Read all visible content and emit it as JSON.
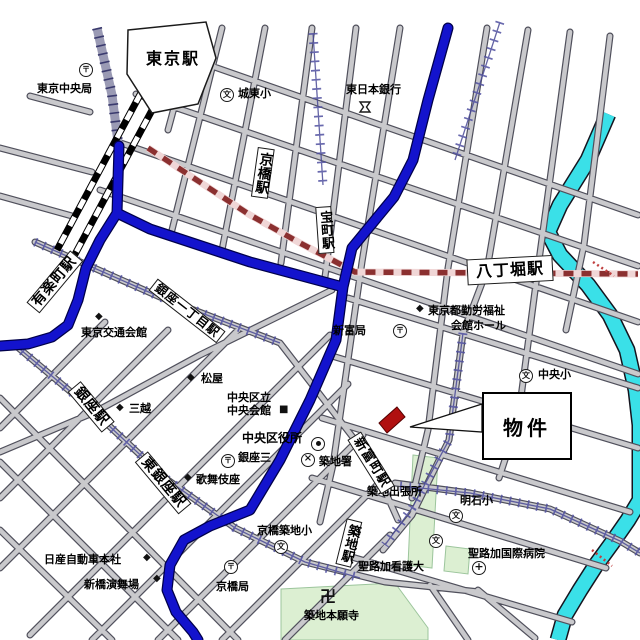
{
  "map": {
    "stations": {
      "tokyo": "東京駅",
      "yurakucho": "有楽町駅",
      "kyobashi": "京橋駅",
      "takaracho": "宝町駅",
      "hatchobori": "八丁堀駅",
      "ginza_itchome": "銀座一丁目駅",
      "ginza": "銀座駅",
      "higashi_ginza": "東銀座駅",
      "shintomicho": "新富町駅",
      "tsukiji": "築地駅"
    },
    "landmarks": {
      "tokyo_chuo_post": "東京中央局",
      "joto_elem": "城東小",
      "higashi_nippon_bank": "東日本銀行",
      "kotsu_kaikan": "東京交通会館",
      "matsuya": "松屋",
      "mitsukoshi": "三越",
      "chuo_kuritsu": "中央区立",
      "chuo_kaikan": "中央会館",
      "chuo_ward_office": "中央区役所",
      "ginza_san": "銀座三",
      "kabukiza": "歌舞伎座",
      "tsukiji_police": "築地署",
      "tsukiji_branch": "築地出張所",
      "akashi_elem": "明石小",
      "chuo_elem": "中央小",
      "kinro_fukushi_line1": "東京都勤労福祉",
      "kinro_fukushi_line2": "会館ホール",
      "shintomi_post": "新富局",
      "nissan_hq": "日産自動車本社",
      "enbujo": "新橋演舞場",
      "kyobashi_post": "京橋局",
      "kyobashi_tsukiji_elem": "京橋築地小",
      "honganji": "築地本願寺",
      "st_luke_hospital": "聖路加国際病院",
      "st_luke_college": "聖路加看護大"
    },
    "property": {
      "label": "物件"
    },
    "icons": {
      "post": "〒",
      "school": "文",
      "police": "×",
      "hospital": "+",
      "temple": "卍",
      "diamond": "◆",
      "square": "■"
    },
    "colors": {
      "major_road": "#1313cd",
      "river": "#3ae0e8",
      "road_fill": "#c9c9cc",
      "subway_dash": "#8b3030",
      "park": "#dcefd2",
      "property_marker": "#b01010"
    }
  }
}
